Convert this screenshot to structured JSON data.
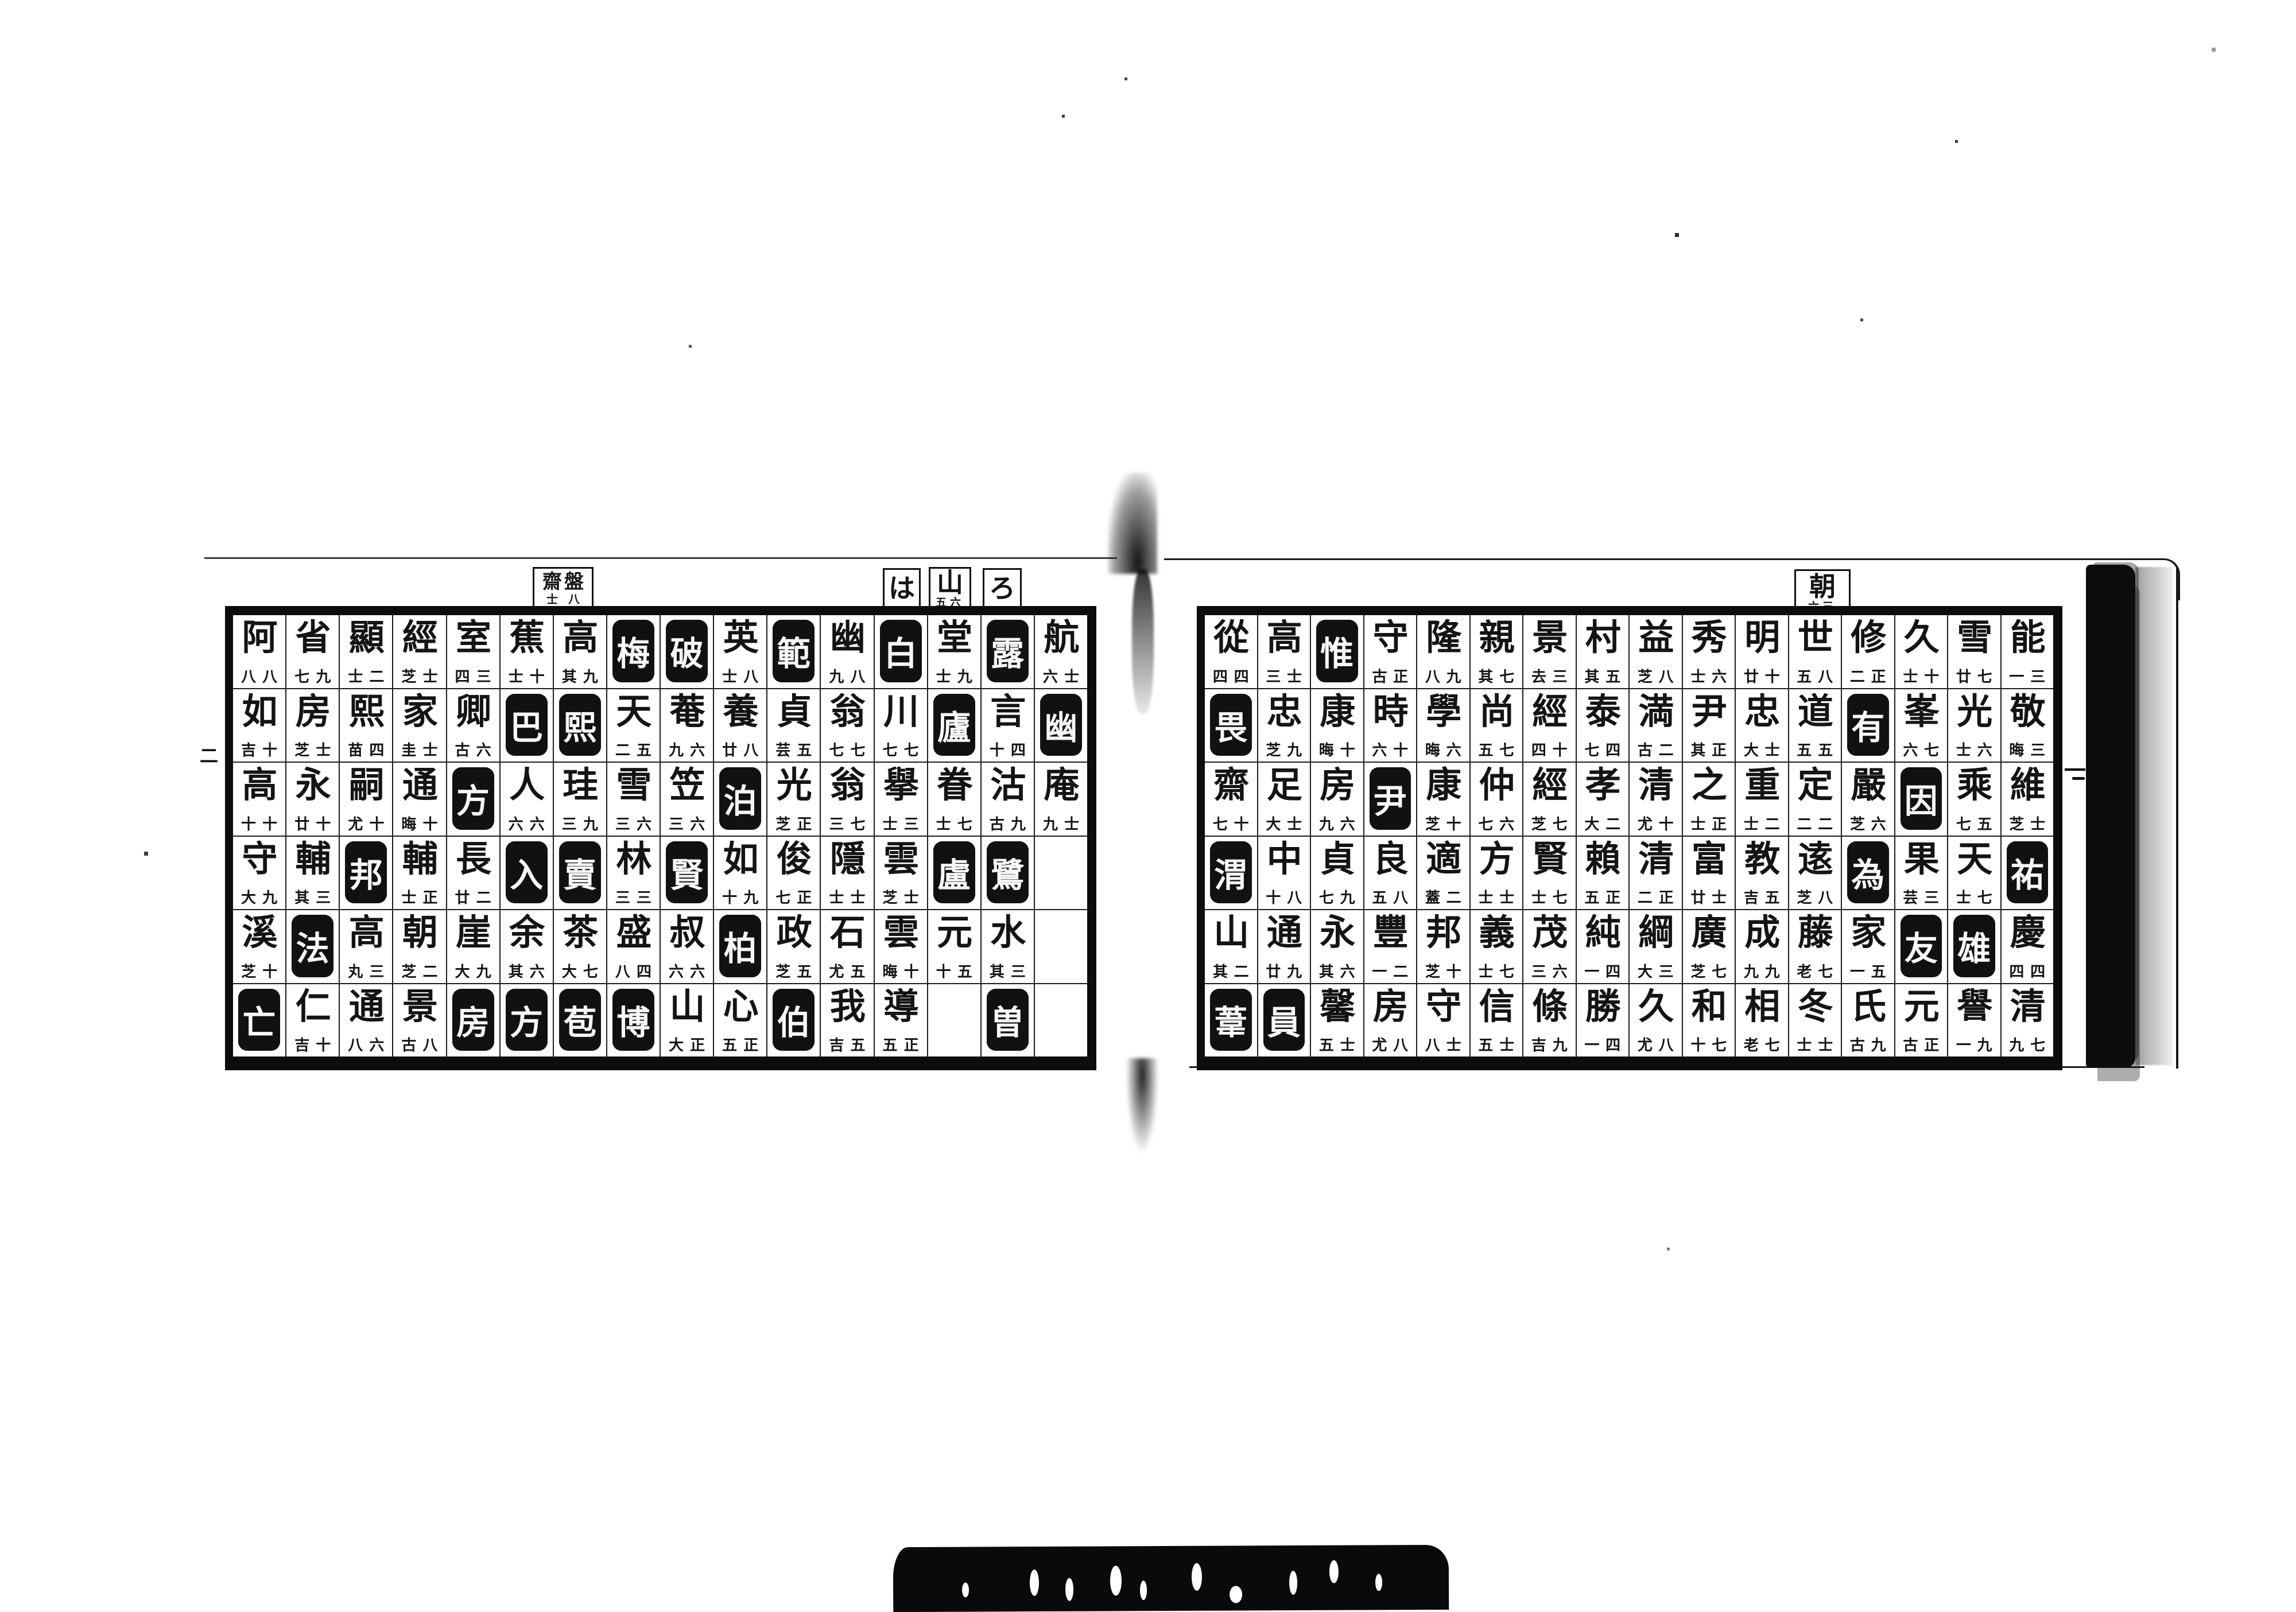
{
  "document": {
    "kind": "woodblock-printed name index, two-page spread",
    "ink_color": "#111111",
    "paper_color": "#ffffff"
  },
  "left_page": {
    "folio": "二",
    "section_tabs": [
      {
        "char": "は",
        "note": ""
      },
      {
        "char": "山",
        "note": "五六"
      },
      {
        "char": "ろ",
        "note": ""
      }
    ],
    "ref_box": {
      "right_char": "盤",
      "right_note": "八",
      "left_char": "齋",
      "left_note": "士"
    },
    "columns": [
      {
        "cells": [
          {
            "ch": "航",
            "note": "六 士"
          },
          {
            "ch": "幽",
            "inv": true
          },
          {
            "ch": "庵",
            "note": "九 士"
          },
          {
            "ch": ""
          },
          {
            "ch": ""
          },
          {
            "ch": ""
          }
        ]
      },
      {
        "cells": [
          {
            "ch": "露",
            "inv": true
          },
          {
            "ch": "言",
            "note": "十 四"
          },
          {
            "ch": "沽",
            "note": "古 九"
          },
          {
            "ch": "鷺",
            "inv": true
          },
          {
            "ch": "水",
            "note": "其 三"
          },
          {
            "ch": "曽",
            "inv": true
          }
        ]
      },
      {
        "cells": [
          {
            "ch": "堂",
            "note": "士 九"
          },
          {
            "ch": "廬",
            "inv": true
          },
          {
            "ch": "眷",
            "note": "士 七"
          },
          {
            "ch": "盧",
            "inv": true
          },
          {
            "ch": "元",
            "note": "十 五"
          },
          {
            "ch": ""
          }
        ]
      },
      {
        "cells": [
          {
            "ch": "白",
            "inv": true
          },
          {
            "ch": "川",
            "note": "七 七"
          },
          {
            "ch": "擧",
            "note": "士 三"
          },
          {
            "ch": "雲",
            "note": "芝 士"
          },
          {
            "ch": "雲",
            "note": "晦 十"
          },
          {
            "ch": "導",
            "note": "五 正"
          }
        ]
      },
      {
        "cells": [
          {
            "ch": "幽",
            "note": "九 八"
          },
          {
            "ch": "翁",
            "note": "七 七"
          },
          {
            "ch": "翁",
            "note": "三 七"
          },
          {
            "ch": "隱",
            "note": "士 士"
          },
          {
            "ch": "石",
            "note": "尤 五"
          },
          {
            "ch": "我",
            "note": "吉 五"
          }
        ]
      },
      {
        "cells": [
          {
            "ch": "範",
            "inv": true
          },
          {
            "ch": "貞",
            "note": "芸 五"
          },
          {
            "ch": "光",
            "note": "芝 正"
          },
          {
            "ch": "俊",
            "note": "七 正"
          },
          {
            "ch": "政",
            "note": "芝 五"
          },
          {
            "ch": "伯",
            "inv": true
          }
        ]
      },
      {
        "cells": [
          {
            "ch": "英",
            "note": "士 八"
          },
          {
            "ch": "養",
            "note": "廿 八"
          },
          {
            "ch": "泊",
            "inv": true
          },
          {
            "ch": "如",
            "note": "十 九"
          },
          {
            "ch": "柏",
            "inv": true
          },
          {
            "ch": "心",
            "note": "五 正"
          }
        ]
      },
      {
        "cells": [
          {
            "ch": "破",
            "inv": true
          },
          {
            "ch": "菴",
            "note": "九 六"
          },
          {
            "ch": "笠",
            "note": "三 六"
          },
          {
            "ch": "賢",
            "inv": true
          },
          {
            "ch": "叔",
            "note": "六 六"
          },
          {
            "ch": "山",
            "note": "大 正"
          }
        ]
      },
      {
        "cells": [
          {
            "ch": "梅",
            "inv": true
          },
          {
            "ch": "天",
            "note": "二 五"
          },
          {
            "ch": "雪",
            "note": "三 六"
          },
          {
            "ch": "林",
            "note": "三 三"
          },
          {
            "ch": "盛",
            "note": "八 四"
          },
          {
            "ch": "博",
            "inv": true
          }
        ]
      },
      {
        "cells": [
          {
            "ch": "高",
            "note": "其 九"
          },
          {
            "ch": "熙",
            "inv": true
          },
          {
            "ch": "珪",
            "note": "三 九"
          },
          {
            "ch": "賣",
            "inv": true
          },
          {
            "ch": "茶",
            "note": "大 七"
          },
          {
            "ch": "苞",
            "inv": true
          }
        ]
      },
      {
        "cells": [
          {
            "ch": "蕉",
            "note": "士 十"
          },
          {
            "ch": "巴",
            "inv": true
          },
          {
            "ch": "人",
            "note": "六 六"
          },
          {
            "ch": "入",
            "inv": true
          },
          {
            "ch": "余",
            "note": "其 六"
          },
          {
            "ch": "方",
            "inv": true
          }
        ]
      },
      {
        "cells": [
          {
            "ch": "室",
            "note": "四 三"
          },
          {
            "ch": "卿",
            "note": "古 六"
          },
          {
            "ch": "方",
            "inv": true
          },
          {
            "ch": "長",
            "note": "廿 二"
          },
          {
            "ch": "崖",
            "note": "大 九"
          },
          {
            "ch": "房",
            "inv": true
          }
        ]
      },
      {
        "cells": [
          {
            "ch": "經",
            "note": "芝 士"
          },
          {
            "ch": "家",
            "note": "圭 士"
          },
          {
            "ch": "通",
            "note": "晦 十"
          },
          {
            "ch": "輔",
            "note": "士 正"
          },
          {
            "ch": "朝",
            "note": "芝 二"
          },
          {
            "ch": "景",
            "note": "古 八"
          }
        ]
      },
      {
        "cells": [
          {
            "ch": "顯",
            "note": "士 二"
          },
          {
            "ch": "熙",
            "note": "苗 四"
          },
          {
            "ch": "嗣",
            "note": "尤 十"
          },
          {
            "ch": "邦",
            "inv": true
          },
          {
            "ch": "高",
            "note": "丸 三"
          },
          {
            "ch": "通",
            "note": "八 六"
          }
        ]
      },
      {
        "cells": [
          {
            "ch": "省",
            "note": "七 九"
          },
          {
            "ch": "房",
            "note": "芝 士"
          },
          {
            "ch": "永",
            "note": "廿 十"
          },
          {
            "ch": "輔",
            "note": "其 三"
          },
          {
            "ch": "法",
            "inv": true
          },
          {
            "ch": "仁",
            "note": "吉 十"
          }
        ]
      },
      {
        "cells": [
          {
            "ch": "阿",
            "note": "八 八"
          },
          {
            "ch": "如",
            "note": "吉 十"
          },
          {
            "ch": "高",
            "note": "十 十"
          },
          {
            "ch": "守",
            "note": "大 九"
          },
          {
            "ch": "溪",
            "note": "芝 十"
          },
          {
            "ch": "亡",
            "inv": true
          }
        ]
      }
    ]
  },
  "right_page": {
    "folio": "一",
    "section_tabs": [
      {
        "char": "朝",
        "note": "六三"
      }
    ],
    "columns": [
      {
        "cells": [
          {
            "ch": "能",
            "note": "一 三"
          },
          {
            "ch": "敬",
            "note": "晦 三"
          },
          {
            "ch": "維",
            "note": "芝 士"
          },
          {
            "ch": "祐",
            "inv": true
          },
          {
            "ch": "慶",
            "note": "四 四"
          },
          {
            "ch": "清",
            "note": "九 七"
          }
        ]
      },
      {
        "cells": [
          {
            "ch": "雪",
            "note": "廿 七"
          },
          {
            "ch": "光",
            "note": "士 六"
          },
          {
            "ch": "乘",
            "note": "七 五"
          },
          {
            "ch": "天",
            "note": "士 七"
          },
          {
            "ch": "雄",
            "inv": true
          },
          {
            "ch": "譽",
            "note": "一 九"
          }
        ]
      },
      {
        "cells": [
          {
            "ch": "久",
            "note": "士 十"
          },
          {
            "ch": "峯",
            "note": "六 七"
          },
          {
            "ch": "因",
            "inv": true
          },
          {
            "ch": "果",
            "note": "芸 三"
          },
          {
            "ch": "友",
            "inv": true
          },
          {
            "ch": "元",
            "note": "古 正"
          }
        ]
      },
      {
        "cells": [
          {
            "ch": "修",
            "note": "二 正"
          },
          {
            "ch": "有",
            "inv": true
          },
          {
            "ch": "嚴",
            "note": "芝 六"
          },
          {
            "ch": "為",
            "inv": true
          },
          {
            "ch": "家",
            "note": "一 五"
          },
          {
            "ch": "氏",
            "note": "古 九"
          }
        ]
      },
      {
        "cells": [
          {
            "ch": "世",
            "note": "五 八"
          },
          {
            "ch": "道",
            "note": "五 五"
          },
          {
            "ch": "定",
            "note": "二 二"
          },
          {
            "ch": "逺",
            "note": "芝 八"
          },
          {
            "ch": "藤",
            "note": "老 七"
          },
          {
            "ch": "冬",
            "note": "士 士"
          }
        ]
      },
      {
        "cells": [
          {
            "ch": "明",
            "note": "廿 十"
          },
          {
            "ch": "忠",
            "note": "大 士"
          },
          {
            "ch": "重",
            "note": "士 二"
          },
          {
            "ch": "教",
            "note": "吉 五"
          },
          {
            "ch": "成",
            "note": "九 九"
          },
          {
            "ch": "相",
            "note": "老 七"
          }
        ]
      },
      {
        "cells": [
          {
            "ch": "秀",
            "note": "士 六"
          },
          {
            "ch": "尹",
            "note": "其 正"
          },
          {
            "ch": "之",
            "note": "士 正"
          },
          {
            "ch": "富",
            "note": "廿 士"
          },
          {
            "ch": "廣",
            "note": "芝 七"
          },
          {
            "ch": "和",
            "note": "十 七"
          }
        ]
      },
      {
        "cells": [
          {
            "ch": "益",
            "note": "芝 八"
          },
          {
            "ch": "満",
            "note": "古 二"
          },
          {
            "ch": "清",
            "note": "尤 十"
          },
          {
            "ch": "清",
            "note": "二 正"
          },
          {
            "ch": "綱",
            "note": "大 三"
          },
          {
            "ch": "久",
            "note": "尤 八"
          }
        ]
      },
      {
        "cells": [
          {
            "ch": "村",
            "note": "其 五"
          },
          {
            "ch": "泰",
            "note": "七 四"
          },
          {
            "ch": "孝",
            "note": "大 二"
          },
          {
            "ch": "賴",
            "note": "五 正"
          },
          {
            "ch": "純",
            "note": "一 四"
          },
          {
            "ch": "勝",
            "note": "一 四"
          }
        ]
      },
      {
        "cells": [
          {
            "ch": "景",
            "note": "去 三"
          },
          {
            "ch": "經",
            "note": "四 十"
          },
          {
            "ch": "經",
            "note": "芝 七"
          },
          {
            "ch": "賢",
            "note": "士 七"
          },
          {
            "ch": "茂",
            "note": "三 六"
          },
          {
            "ch": "條",
            "note": "吉 九"
          }
        ]
      },
      {
        "cells": [
          {
            "ch": "親",
            "note": "其 七"
          },
          {
            "ch": "尚",
            "note": "五 七"
          },
          {
            "ch": "仲",
            "note": "七 六"
          },
          {
            "ch": "方",
            "note": "士 士"
          },
          {
            "ch": "義",
            "note": "士 七"
          },
          {
            "ch": "信",
            "note": "五 士"
          }
        ]
      },
      {
        "cells": [
          {
            "ch": "隆",
            "note": "八 九"
          },
          {
            "ch": "學",
            "note": "晦 六"
          },
          {
            "ch": "康",
            "note": "芝 十"
          },
          {
            "ch": "適",
            "note": "蓋 二"
          },
          {
            "ch": "邦",
            "note": "芝 十"
          },
          {
            "ch": "守",
            "note": "八 士"
          }
        ]
      },
      {
        "cells": [
          {
            "ch": "守",
            "note": "古 正"
          },
          {
            "ch": "時",
            "note": "六 十"
          },
          {
            "ch": "尹",
            "inv": true
          },
          {
            "ch": "良",
            "note": "五 八"
          },
          {
            "ch": "豐",
            "note": "一 二"
          },
          {
            "ch": "房",
            "note": "尤 八"
          }
        ]
      },
      {
        "cells": [
          {
            "ch": "惟",
            "inv": true
          },
          {
            "ch": "康",
            "note": "晦 十"
          },
          {
            "ch": "房",
            "note": "九 六"
          },
          {
            "ch": "貞",
            "note": "七 九"
          },
          {
            "ch": "永",
            "note": "其 六"
          },
          {
            "ch": "馨",
            "note": "五 士"
          }
        ]
      },
      {
        "cells": [
          {
            "ch": "高",
            "note": "三 士"
          },
          {
            "ch": "忠",
            "note": "芝 九"
          },
          {
            "ch": "足",
            "note": "大 士"
          },
          {
            "ch": "中",
            "note": "十 八"
          },
          {
            "ch": "通",
            "note": "廿 九"
          },
          {
            "ch": "員",
            "inv": true
          }
        ]
      },
      {
        "cells": [
          {
            "ch": "從",
            "note": "四 四"
          },
          {
            "ch": "畏",
            "inv": true
          },
          {
            "ch": "齋",
            "note": "七 十"
          },
          {
            "ch": "渭",
            "inv": true
          },
          {
            "ch": "山",
            "note": "其 二"
          },
          {
            "ch": "葦",
            "inv": true
          }
        ]
      }
    ]
  }
}
